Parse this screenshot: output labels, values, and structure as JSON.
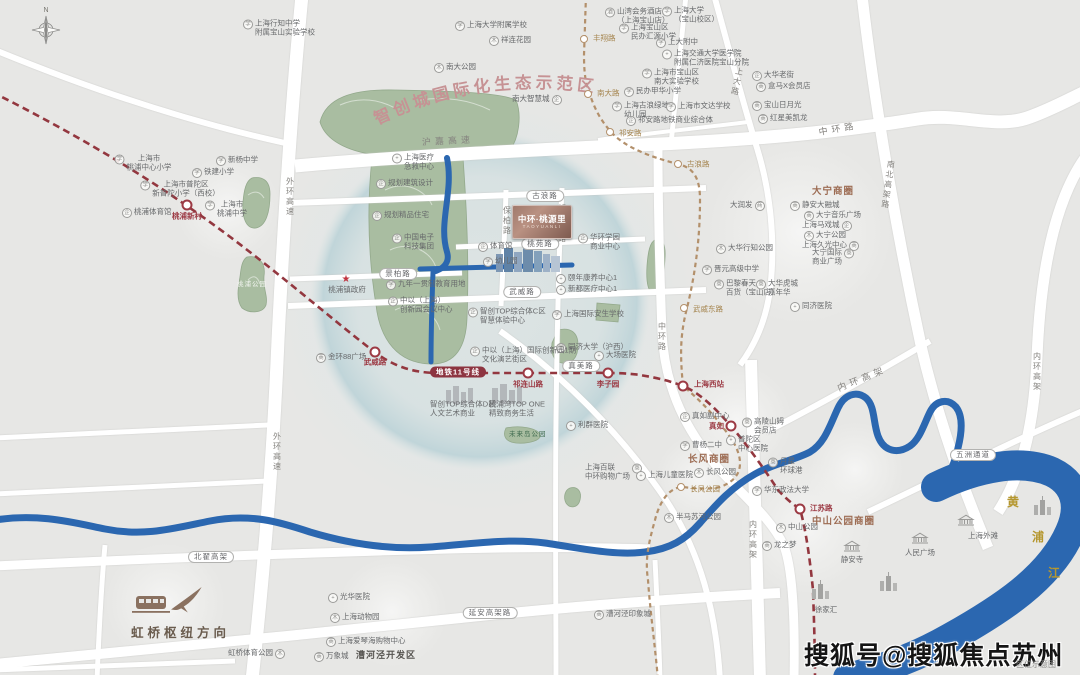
{
  "eco": {
    "text": "智创城国际化生态示范区"
  },
  "project": {
    "name": "中环·桃源里",
    "pinyin": "TAOYUANLI"
  },
  "compass": {
    "n": "N"
  },
  "hongqiao": {
    "label": "虹桥枢纽方向"
  },
  "watermark": {
    "text": "搜狐号@搜狐焦点苏州站",
    "note": "区位示意图"
  },
  "colors": {
    "road": "#ffffff",
    "park": "#a9bda1",
    "river": "#2b67b0",
    "metro_red": "#93373f",
    "metro_gold": "#b3906b",
    "accent_brown": "#9c6b52",
    "eco_rose": "#c69294"
  },
  "icon_glyphs": {
    "school": "学",
    "hosp": "+",
    "park": "木",
    "shop": "商",
    "hotel": "酒",
    "biz": "企"
  },
  "metro": {
    "line11_label": "地铁11号线",
    "red_stations": [
      {
        "name": "桃浦新村",
        "x": 187,
        "y": 205,
        "lx": 187,
        "ly": 216,
        "la": "c"
      },
      {
        "name": "武威路",
        "x": 375,
        "y": 352,
        "lx": 375,
        "ly": 362,
        "la": "c"
      },
      {
        "name": "祁连山路",
        "x": 528,
        "y": 373,
        "lx": 528,
        "ly": 384,
        "la": "c"
      },
      {
        "name": "李子园",
        "x": 608,
        "y": 373,
        "lx": 608,
        "ly": 384,
        "la": "c"
      },
      {
        "name": "上海西站",
        "x": 683,
        "y": 386,
        "lx": 694,
        "ly": 384,
        "la": "l"
      },
      {
        "name": "真如",
        "x": 731,
        "y": 426,
        "lx": 724,
        "ly": 426,
        "la": "r"
      },
      {
        "name": "江苏路",
        "x": 800,
        "y": 509,
        "lx": 810,
        "ly": 508,
        "la": "l"
      }
    ],
    "gold_stations": [
      {
        "name": "丰翔路",
        "x": 584,
        "y": 39,
        "lx": 593,
        "ly": 38,
        "la": "l"
      },
      {
        "name": "南大路",
        "x": 588,
        "y": 94,
        "lx": 597,
        "ly": 93,
        "la": "l"
      },
      {
        "name": "祁安路",
        "x": 610,
        "y": 132,
        "lx": 619,
        "ly": 133,
        "la": "l"
      },
      {
        "name": "古浪路",
        "x": 678,
        "y": 164,
        "lx": 687,
        "ly": 164,
        "la": "l"
      },
      {
        "name": "武威东路",
        "x": 684,
        "y": 308,
        "lx": 693,
        "ly": 309,
        "la": "l"
      },
      {
        "name": "长风公园",
        "x": 681,
        "y": 487,
        "lx": 690,
        "ly": 489,
        "la": "l"
      }
    ]
  },
  "labels": [
    {
      "t": "N",
      "x": 46,
      "y": 11,
      "cls": "compassn",
      "a": "c"
    },
    {
      "t": "上海行知中学\n附属宝山实验学校",
      "x": 243,
      "y": 28,
      "cls": "poi",
      "ic": "school"
    },
    {
      "t": "上海市\n桃浦中心小学",
      "x": 143,
      "y": 163,
      "cls": "poi",
      "ic": "school",
      "a": "c"
    },
    {
      "t": "新杨中学",
      "x": 216,
      "y": 161,
      "cls": "poi",
      "ic": "school"
    },
    {
      "t": "铁建小学",
      "x": 192,
      "y": 173,
      "cls": "poi",
      "ic": "school"
    },
    {
      "t": "上海市普陀区\n新普陀小学（西校）",
      "x": 180,
      "y": 189,
      "cls": "poi",
      "ic": "school",
      "a": "c"
    },
    {
      "t": "桃浦体育馆",
      "x": 122,
      "y": 213,
      "cls": "poi",
      "ic": "biz"
    },
    {
      "t": "上海市\n桃浦中学",
      "x": 226,
      "y": 209,
      "cls": "poi",
      "ic": "school",
      "a": "c"
    },
    {
      "t": "上海大学附属学校",
      "x": 455,
      "y": 26,
      "cls": "poi",
      "ic": "school"
    },
    {
      "t": "祥连花园",
      "x": 489,
      "y": 41,
      "cls": "poi",
      "ic": "park"
    },
    {
      "t": "南大公园",
      "x": 434,
      "y": 68,
      "cls": "poi",
      "ic": "park"
    },
    {
      "t": "南大智慧城",
      "x": 512,
      "y": 100,
      "cls": "poi",
      "ic": "biz",
      "side": "r"
    },
    {
      "t": "山湾会务酒店\n（上海宝山店）",
      "x": 605,
      "y": 16,
      "cls": "poi",
      "ic": "hotel"
    },
    {
      "t": "上海大学\n（宝山校区）",
      "x": 662,
      "y": 15,
      "cls": "poi",
      "ic": "school"
    },
    {
      "t": "上海宝山区\n民办汇源小学",
      "x": 619,
      "y": 32,
      "cls": "poi",
      "ic": "school"
    },
    {
      "t": "上大附中",
      "x": 656,
      "y": 43,
      "cls": "poi",
      "ic": "school"
    },
    {
      "t": "上海交通大学医学院\n附属仁济医院宝山分院",
      "x": 662,
      "y": 58,
      "cls": "poi",
      "ic": "hosp"
    },
    {
      "t": "上海市宝山区\n南大实验学校",
      "x": 642,
      "y": 77,
      "cls": "poi",
      "ic": "school"
    },
    {
      "t": "民办甲华小学",
      "x": 624,
      "y": 92,
      "cls": "poi",
      "ic": "school"
    },
    {
      "t": "上海古浪绿地\n幼儿园",
      "x": 612,
      "y": 110,
      "cls": "poi",
      "ic": "school"
    },
    {
      "t": "上海市文达学校",
      "x": 666,
      "y": 107,
      "cls": "poi",
      "ic": "school"
    },
    {
      "t": "祁安路地铁商业综合体",
      "x": 626,
      "y": 121,
      "cls": "poi",
      "ic": "biz"
    },
    {
      "t": "大华老街",
      "x": 752,
      "y": 76,
      "cls": "poi",
      "ic": "biz"
    },
    {
      "t": "盒马X会员店",
      "x": 756,
      "y": 87,
      "cls": "poi",
      "ic": "shop"
    },
    {
      "t": "宝山日月光",
      "x": 752,
      "y": 106,
      "cls": "poi",
      "ic": "shop"
    },
    {
      "t": "红星美凯龙",
      "x": 758,
      "y": 119,
      "cls": "poi",
      "ic": "shop"
    },
    {
      "t": "上海医疗\n急救中心",
      "x": 392,
      "y": 162,
      "cls": "poi",
      "ic": "hosp"
    },
    {
      "t": "规划建筑设计",
      "x": 376,
      "y": 184,
      "cls": "poi",
      "ic": "biz"
    },
    {
      "t": "规划精品住宅",
      "x": 372,
      "y": 216,
      "cls": "poi",
      "ic": "biz"
    },
    {
      "t": "中国电子\n科技集团",
      "x": 392,
      "y": 242,
      "cls": "poi",
      "ic": "biz"
    },
    {
      "t": "★",
      "x": 346,
      "y": 280,
      "cls": "star",
      "a": "c"
    },
    {
      "t": "桃浦镇政府",
      "x": 347,
      "y": 290,
      "cls": "poi",
      "a": "c"
    },
    {
      "t": "九年一贯制教育用地",
      "x": 386,
      "y": 285,
      "cls": "poi",
      "ic": "school"
    },
    {
      "t": "中以（上海）\n创新园会议中心",
      "x": 388,
      "y": 305,
      "cls": "poi",
      "ic": "biz"
    },
    {
      "t": "金环88广场",
      "x": 316,
      "y": 358,
      "cls": "poi",
      "ic": "shop"
    },
    {
      "t": "体育馆",
      "x": 478,
      "y": 247,
      "cls": "poi",
      "ic": "biz"
    },
    {
      "t": "幼儿园",
      "x": 483,
      "y": 262,
      "cls": "poi",
      "ic": "school"
    },
    {
      "t": "华环学园\n商业中心",
      "x": 578,
      "y": 242,
      "cls": "poi",
      "ic": "biz"
    },
    {
      "t": "颐年康养中心1",
      "x": 556,
      "y": 279,
      "cls": "poi",
      "ic": "hosp"
    },
    {
      "t": "新都医疗中心1",
      "x": 556,
      "y": 290,
      "cls": "poi",
      "ic": "hosp"
    },
    {
      "t": "智创TOP综合体C区\n智慧体验中心",
      "x": 468,
      "y": 316,
      "cls": "poi",
      "ic": "biz"
    },
    {
      "t": "上海国际安生学校",
      "x": 552,
      "y": 315,
      "cls": "poi",
      "ic": "school"
    },
    {
      "t": "同济大学（沪西）",
      "x": 556,
      "y": 348,
      "cls": "poi",
      "ic": "school"
    },
    {
      "t": "中以（上海）国际创新园1期\n文化演艺街区",
      "x": 470,
      "y": 355,
      "cls": "poi",
      "ic": "biz"
    },
    {
      "t": "智创TOP综合体D区\n人文艺术商业",
      "x": 430,
      "y": 409,
      "cls": "poi"
    },
    {
      "t": "桃浦湾TOP ONE\n精致商务生活",
      "x": 489,
      "y": 409,
      "cls": "poi"
    },
    {
      "t": "大场医院",
      "x": 594,
      "y": 356,
      "cls": "poi",
      "ic": "hosp"
    },
    {
      "t": "利群医院",
      "x": 566,
      "y": 426,
      "cls": "poi",
      "ic": "hosp"
    },
    {
      "t": "未来岛公园",
      "x": 509,
      "y": 435,
      "cls": "parklbl"
    },
    {
      "t": "上海百联\n中环购物广场",
      "x": 585,
      "y": 472,
      "cls": "poi",
      "ic": "shop",
      "side": "r"
    },
    {
      "t": "上海儿童医院",
      "x": 636,
      "y": 476,
      "cls": "poi",
      "ic": "hosp"
    },
    {
      "t": "真如副中心",
      "x": 680,
      "y": 417,
      "cls": "poi",
      "ic": "biz"
    },
    {
      "t": "曹杨二中",
      "x": 680,
      "y": 446,
      "cls": "poi",
      "ic": "school"
    },
    {
      "t": "普陀区\n中心医院",
      "x": 726,
      "y": 444,
      "cls": "poi",
      "ic": "hosp"
    },
    {
      "t": "高陵山姆\n会员店",
      "x": 742,
      "y": 426,
      "cls": "poi",
      "ic": "shop"
    },
    {
      "t": "长风商圈",
      "x": 688,
      "y": 460,
      "cls": "district"
    },
    {
      "t": "长风公园",
      "x": 694,
      "y": 473,
      "cls": "poi",
      "ic": "park"
    },
    {
      "t": "半马苏河公园",
      "x": 664,
      "y": 518,
      "cls": "poi",
      "ic": "park"
    },
    {
      "t": "月星\n环球港",
      "x": 768,
      "y": 466,
      "cls": "poi",
      "ic": "shop"
    },
    {
      "t": "华东政法大学",
      "x": 752,
      "y": 491,
      "cls": "poi",
      "ic": "school"
    },
    {
      "t": "中山公园",
      "x": 776,
      "y": 528,
      "cls": "poi",
      "ic": "park"
    },
    {
      "t": "中山公园商圈",
      "x": 812,
      "y": 522,
      "cls": "district"
    },
    {
      "t": "龙之梦",
      "x": 762,
      "y": 546,
      "cls": "poi",
      "ic": "shop"
    },
    {
      "t": "静安寺",
      "x": 852,
      "y": 560,
      "cls": "poi",
      "a": "c"
    },
    {
      "t": "人民广场",
      "x": 920,
      "y": 553,
      "cls": "poi",
      "a": "c"
    },
    {
      "t": "上海外滩",
      "x": 983,
      "y": 536,
      "cls": "poi",
      "a": "c"
    },
    {
      "t": "徐家汇",
      "x": 826,
      "y": 610,
      "cls": "poi",
      "a": "c"
    },
    {
      "t": "大宁商圈",
      "x": 812,
      "y": 192,
      "cls": "district"
    },
    {
      "t": "静安大融城",
      "x": 790,
      "y": 206,
      "cls": "poi",
      "ic": "shop"
    },
    {
      "t": "大润发",
      "x": 730,
      "y": 206,
      "cls": "poi",
      "ic": "shop",
      "side": "r"
    },
    {
      "t": "大宁音乐广场",
      "x": 804,
      "y": 216,
      "cls": "poi",
      "ic": "shop"
    },
    {
      "t": "上海马戏城",
      "x": 802,
      "y": 226,
      "cls": "poi",
      "ic": "biz",
      "side": "r"
    },
    {
      "t": "大宁公园",
      "x": 804,
      "y": 236,
      "cls": "poi",
      "ic": "park"
    },
    {
      "t": "上海久光中心",
      "x": 802,
      "y": 246,
      "cls": "poi",
      "ic": "shop",
      "side": "r"
    },
    {
      "t": "大宁国际\n商业广场",
      "x": 812,
      "y": 257,
      "cls": "poi",
      "ic": "shop",
      "side": "r"
    },
    {
      "t": "大华行知公园",
      "x": 716,
      "y": 249,
      "cls": "poi",
      "ic": "park"
    },
    {
      "t": "晋元高级中学",
      "x": 702,
      "y": 270,
      "cls": "poi",
      "ic": "school"
    },
    {
      "t": "巴黎春天\n百货（宝山店）",
      "x": 714,
      "y": 288,
      "cls": "poi",
      "ic": "shop"
    },
    {
      "t": "大华虎城\n嘉年华",
      "x": 756,
      "y": 288,
      "cls": "poi",
      "ic": "shop"
    },
    {
      "t": "同济医院",
      "x": 790,
      "y": 307,
      "cls": "poi",
      "ic": "hosp"
    },
    {
      "t": "光华医院",
      "x": 328,
      "y": 598,
      "cls": "poi",
      "ic": "hosp"
    },
    {
      "t": "上海动物园",
      "x": 330,
      "y": 618,
      "cls": "poi",
      "ic": "park"
    },
    {
      "t": "上海爱琴海购物中心",
      "x": 326,
      "y": 642,
      "cls": "poi",
      "ic": "shop"
    },
    {
      "t": "万象城",
      "x": 314,
      "y": 657,
      "cls": "poi",
      "ic": "shop"
    },
    {
      "t": "漕河泾开发区",
      "x": 356,
      "y": 655,
      "cls": "bolddark"
    },
    {
      "t": "虹桥体育公园",
      "x": 228,
      "y": 654,
      "cls": "poi",
      "ic": "park",
      "side": "r"
    },
    {
      "t": "漕河泾印象城",
      "x": 594,
      "y": 615,
      "cls": "poi",
      "ic": "shop"
    },
    {
      "t": "桃浦公园",
      "x": 252,
      "y": 285,
      "cls": "parkwhite",
      "a": "c"
    },
    {
      "t": "黄",
      "x": 1013,
      "y": 502,
      "cls": "riverch",
      "a": "c"
    },
    {
      "t": "浦",
      "x": 1038,
      "y": 537,
      "cls": "riverch",
      "a": "c"
    },
    {
      "t": "江",
      "x": 1054,
      "y": 573,
      "cls": "riverch",
      "a": "c"
    },
    {
      "t": "古浪路",
      "x": 545,
      "y": 196,
      "cls": "pill",
      "a": "c"
    },
    {
      "t": "桃苑路",
      "x": 540,
      "y": 244,
      "cls": "pill",
      "a": "c"
    },
    {
      "t": "武威路",
      "x": 522,
      "y": 292,
      "cls": "pill",
      "a": "c"
    },
    {
      "t": "景柏路",
      "x": 398,
      "y": 274,
      "cls": "pill",
      "a": "c"
    },
    {
      "t": "真美路",
      "x": 581,
      "y": 366,
      "cls": "pill",
      "a": "c"
    },
    {
      "t": "北翟高架",
      "x": 211,
      "y": 557,
      "cls": "pill",
      "a": "c"
    },
    {
      "t": "延安高架路",
      "x": 490,
      "y": 613,
      "cls": "pill",
      "a": "c"
    },
    {
      "t": "五洲通道",
      "x": 973,
      "y": 455,
      "cls": "pill",
      "a": "c"
    },
    {
      "t": "地铁11号线",
      "x": 458,
      "y": 372,
      "cls": "pilldark",
      "a": "c"
    },
    {
      "t": "沪嘉高速",
      "x": 448,
      "y": 141,
      "cls": "roadlbl",
      "a": "c",
      "rot": -3
    },
    {
      "t": "中环路",
      "x": 838,
      "y": 129,
      "cls": "roadlbl",
      "a": "c",
      "rot": -10
    },
    {
      "t": "内环高架",
      "x": 862,
      "y": 379,
      "cls": "roadlbl",
      "a": "c",
      "rot": -22
    },
    {
      "t": "外环高速",
      "x": 290,
      "y": 197,
      "cls": "vroad",
      "a": "c"
    },
    {
      "t": "外环高速",
      "x": 277,
      "y": 452,
      "cls": "vroad",
      "a": "c"
    },
    {
      "t": "保柏路",
      "x": 507,
      "y": 221,
      "cls": "vroad",
      "a": "c"
    },
    {
      "t": "祁连山路",
      "x": 562,
      "y": 224,
      "cls": "vroad",
      "a": "c"
    },
    {
      "t": "中环路",
      "x": 662,
      "y": 337,
      "cls": "vroad",
      "a": "c"
    },
    {
      "t": "上大路",
      "x": 737,
      "y": 82,
      "cls": "vroad",
      "a": "c",
      "rot": 12
    },
    {
      "t": "南北高架路",
      "x": 888,
      "y": 185,
      "cls": "vroad",
      "a": "c",
      "rot": 8
    },
    {
      "t": "内环高架",
      "x": 753,
      "y": 540,
      "cls": "vroad",
      "a": "c"
    },
    {
      "t": "内环高架",
      "x": 1037,
      "y": 372,
      "cls": "vroad",
      "a": "c"
    }
  ]
}
